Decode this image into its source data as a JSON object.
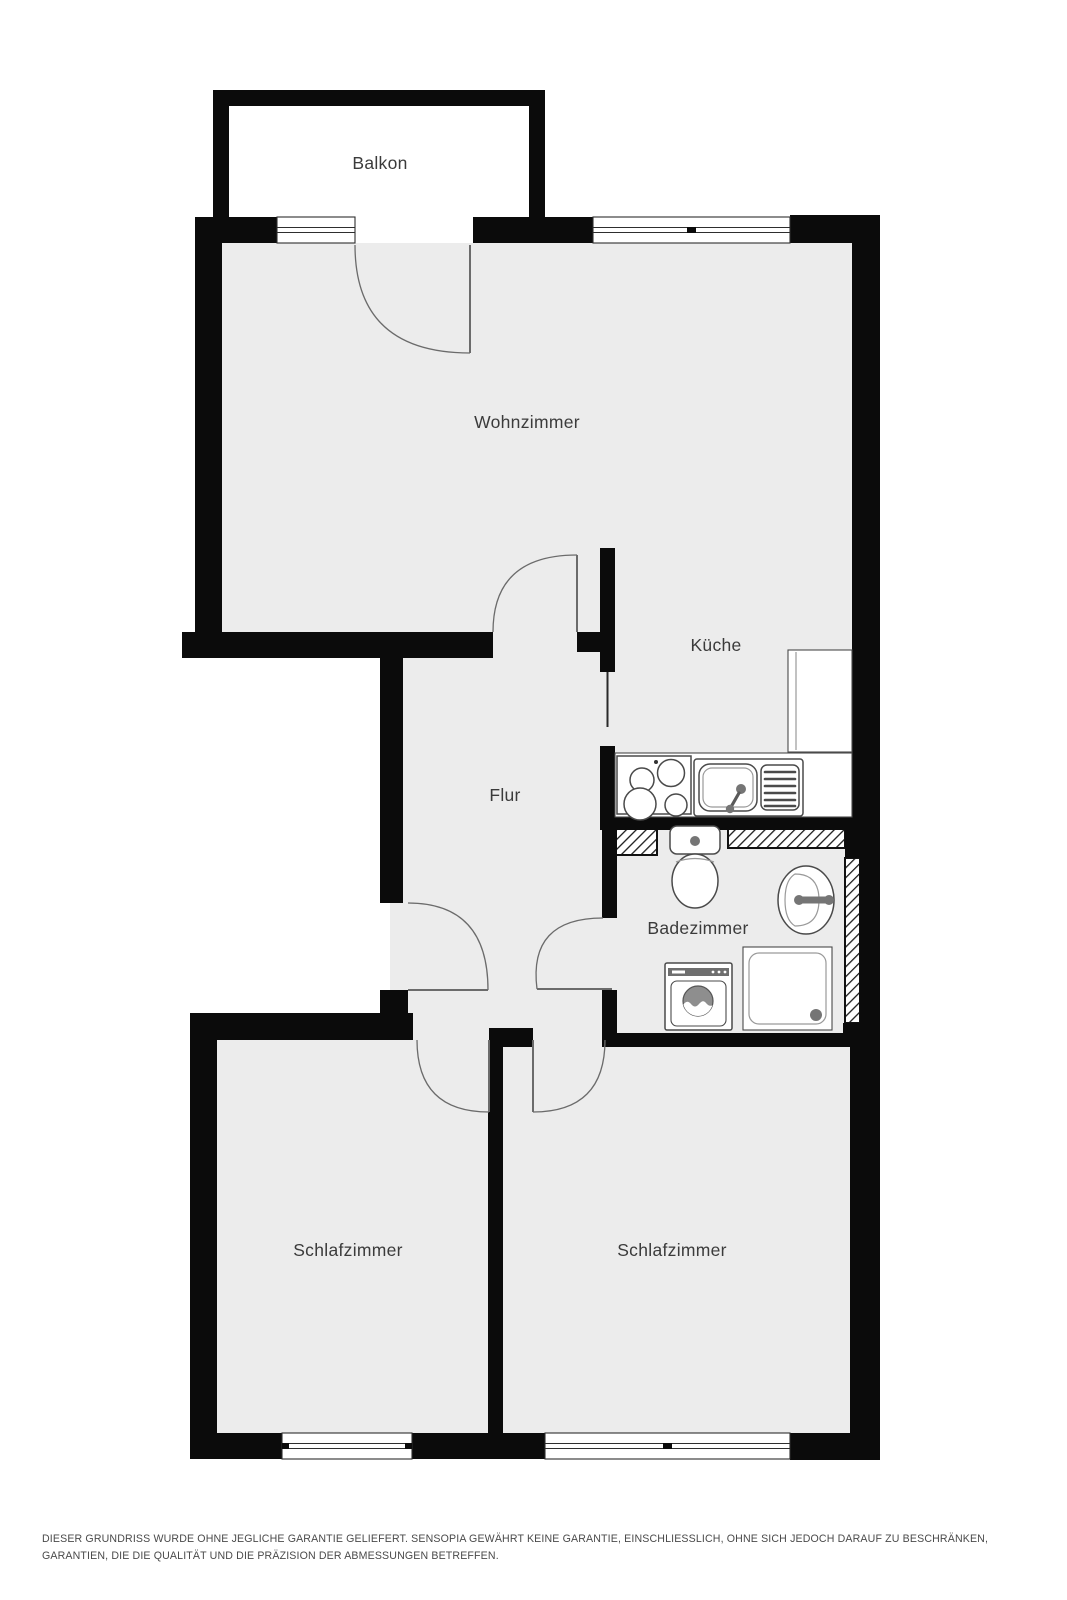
{
  "plan": {
    "rooms": {
      "balcony": "Balkon",
      "living": "Wohnzimmer",
      "kitchen": "Küche",
      "hall": "Flur",
      "bath": "Badezimmer",
      "bedroom_left": "Schlafzimmer",
      "bedroom_right": "Schlafzimmer"
    },
    "fixtures": [
      "stove",
      "kitchen-sink",
      "fridge",
      "toilet",
      "bath-sink",
      "washing-machine",
      "shower"
    ]
  },
  "footer": {
    "disclaimer": "DIESER GRUNDRISS WURDE OHNE JEGLICHE GARANTIE GELIEFERT. SENSOPIA GEWÄHRT KEINE GARANTIE, EINSCHLIESSLICH, OHNE SICH JEDOCH DARAUF ZU BESCHRÄNKEN, GARANTIEN, DIE DIE QUALITÄT UND DIE PRÄZISION DER ABMESSUNGEN BETREFFEN."
  },
  "colors": {
    "background": "#ffffff",
    "floor": "#ececec",
    "wall": "#0b0b0b",
    "room_label": "#3b3b3b",
    "fixture_stroke": "#4a4a4a",
    "fixture_light": "#9a9a9a",
    "door_stroke": "#6b6b6b",
    "appliance_dark": "#757575",
    "disclaimer_text": "#4a4a4a"
  }
}
